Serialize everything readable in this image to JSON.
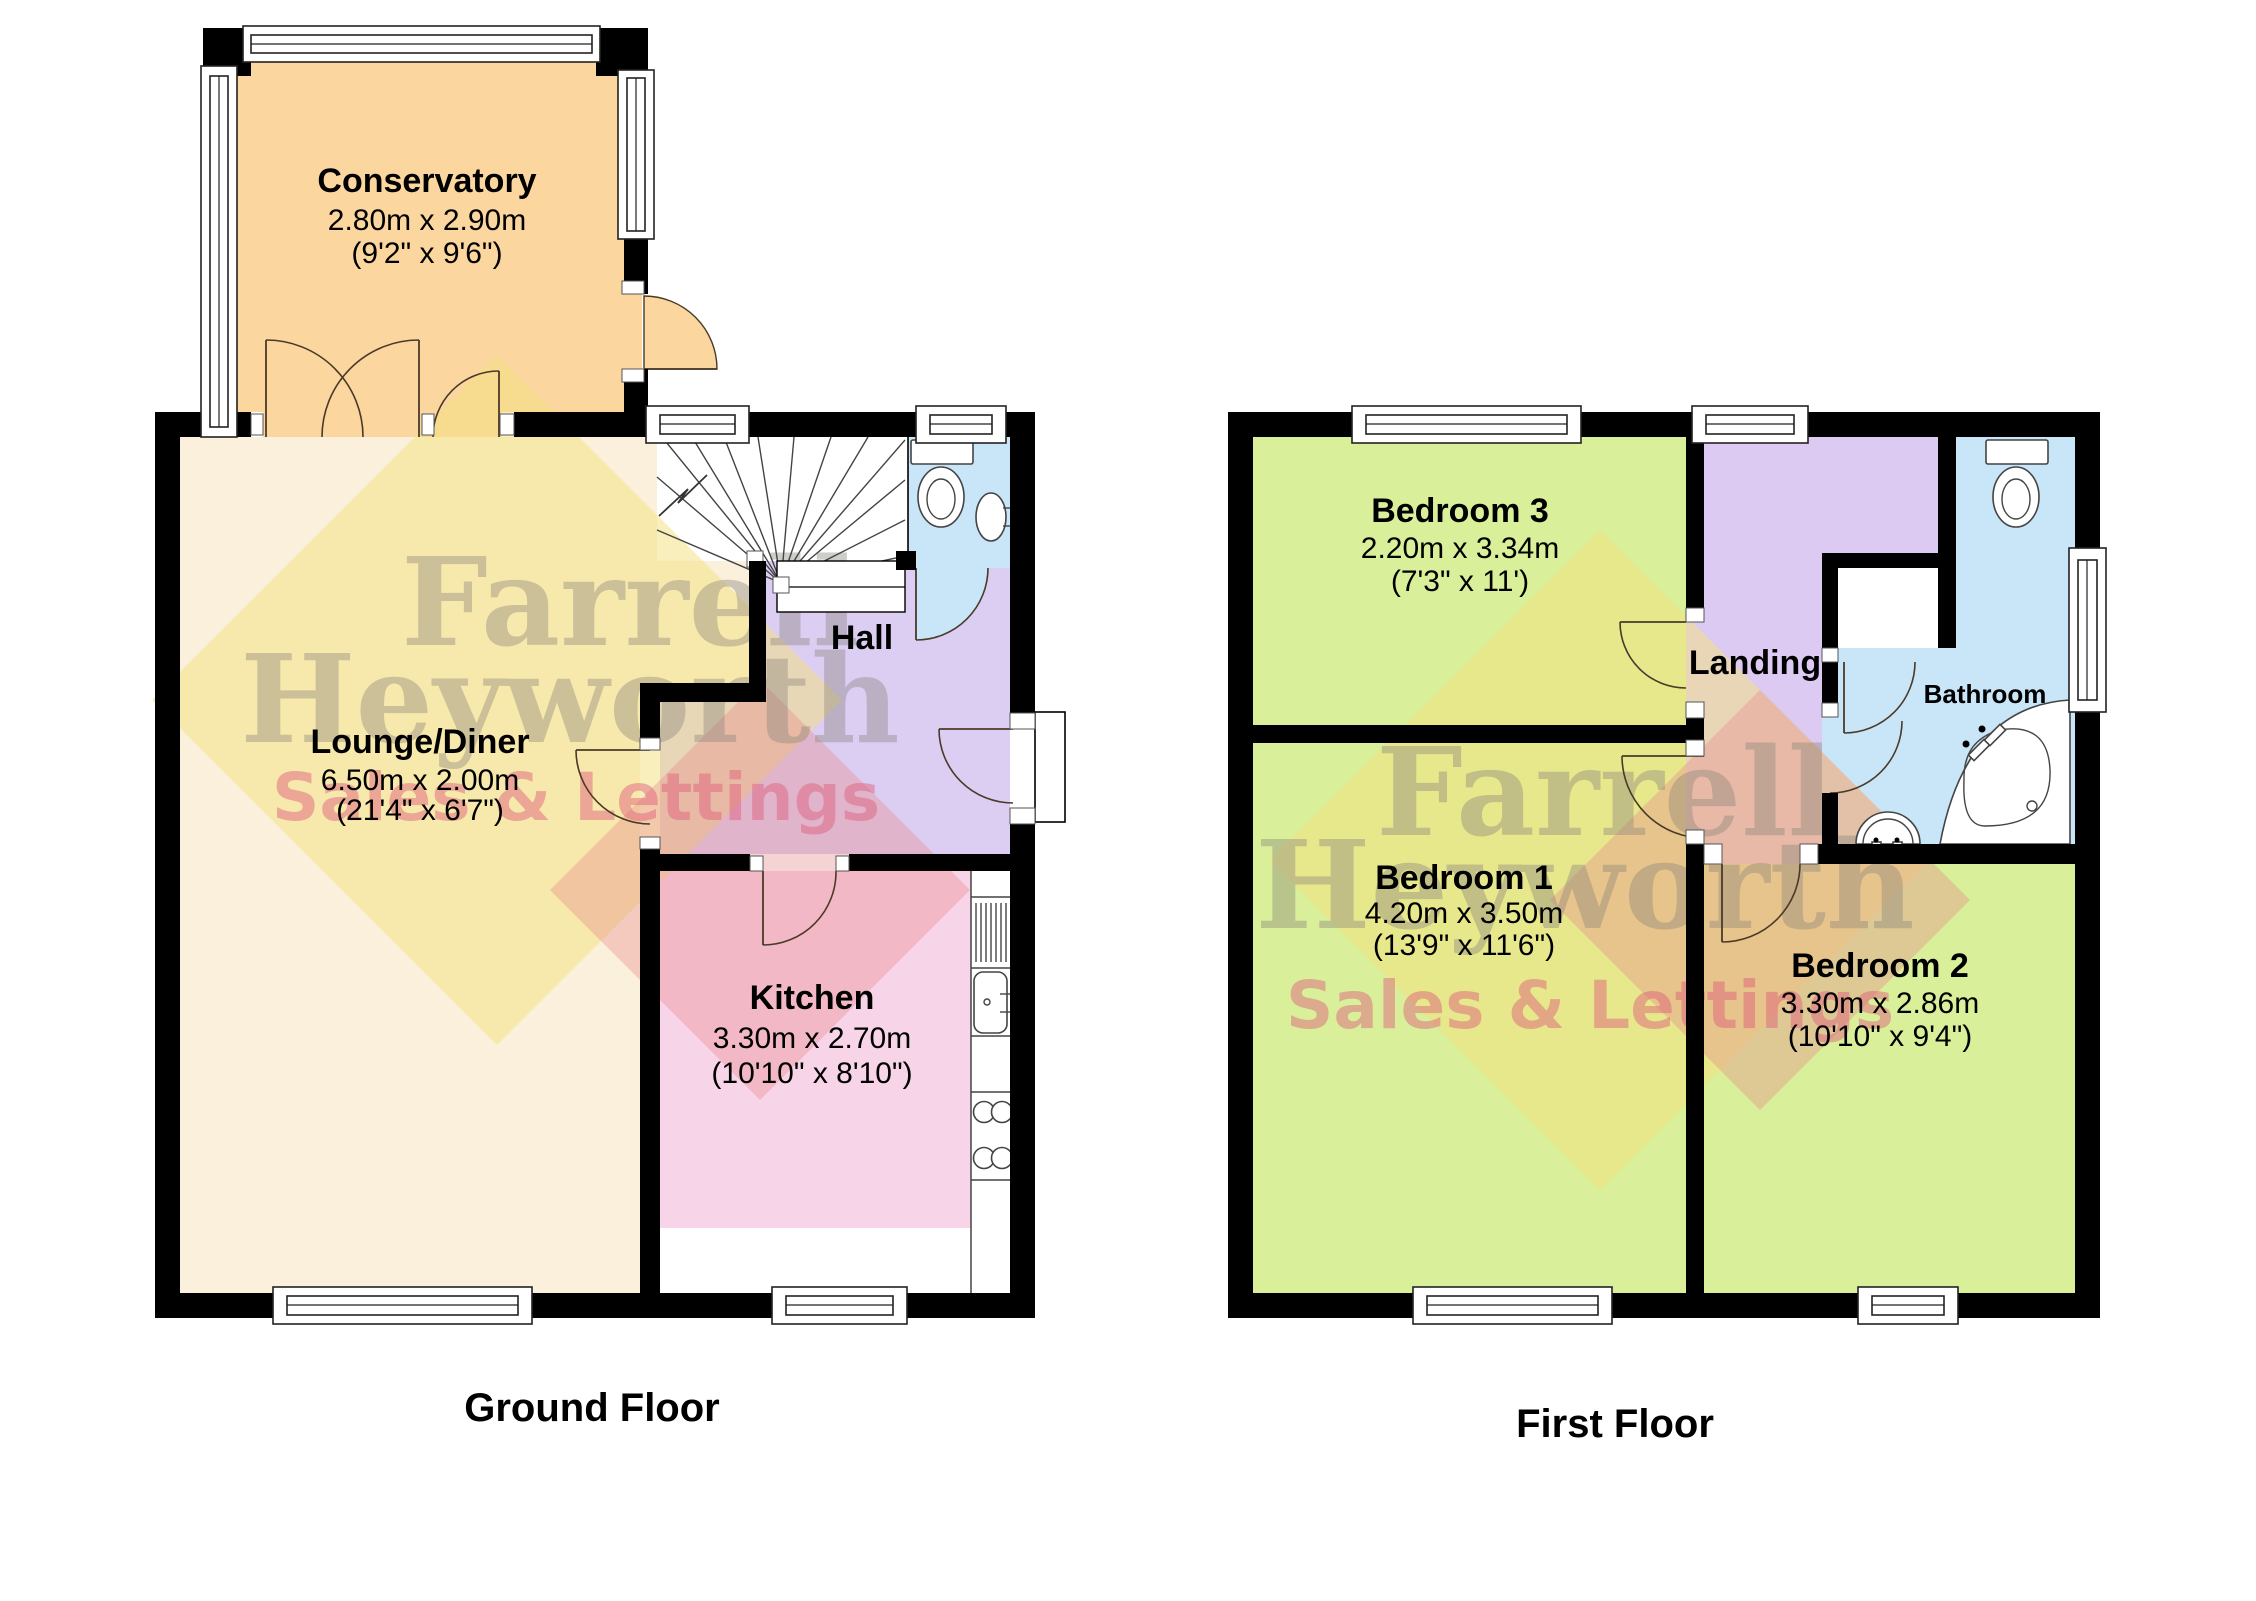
{
  "watermark": {
    "line1": "Farrell",
    "line2": "Heyworth",
    "line3": "Sales & Lettings"
  },
  "ground_floor": {
    "title": "Ground Floor",
    "rooms": {
      "conservatory": {
        "name": "Conservatory",
        "metric": "2.80m x 2.90m",
        "imperial": "(9'2\" x 9'6\")"
      },
      "lounge_diner": {
        "name": "Lounge/Diner",
        "metric": "6.50m x 2.00m",
        "imperial": "(21'4\" x 6'7\")"
      },
      "kitchen": {
        "name": "Kitchen",
        "metric": "3.30m x 2.70m",
        "imperial": "(10'10\" x 8'10\")"
      },
      "hall": {
        "name": "Hall"
      }
    }
  },
  "first_floor": {
    "title": "First Floor",
    "rooms": {
      "bedroom1": {
        "name": "Bedroom 1",
        "metric": "4.20m x 3.50m",
        "imperial": "(13'9\" x 11'6\")"
      },
      "bedroom2": {
        "name": "Bedroom 2",
        "metric": "3.30m x 2.86m",
        "imperial": "(10'10\" x 9'4\")"
      },
      "bedroom3": {
        "name": "Bedroom 3",
        "metric": "2.20m x 3.34m",
        "imperial": "(7'3\" x 11')"
      },
      "landing": {
        "name": "Landing"
      },
      "bathroom": {
        "name": "Bathroom"
      }
    }
  },
  "colors": {
    "walls": "#000000",
    "conservatory": "#fbd69e",
    "lounge": "#faf0dc",
    "kitchen": "#f8d4e8",
    "hall": "#dccdf3",
    "wc_bathroom": "#c9e6f8",
    "bedroom": "#d9ef9a",
    "landing": "#dccaf2",
    "watermark_gray": "#8a857c",
    "watermark_pink": "#e0607e",
    "watermark_yellow": "rgba(243,225,128,0.52)",
    "watermark_red": "rgba(231,140,140,0.38)"
  }
}
